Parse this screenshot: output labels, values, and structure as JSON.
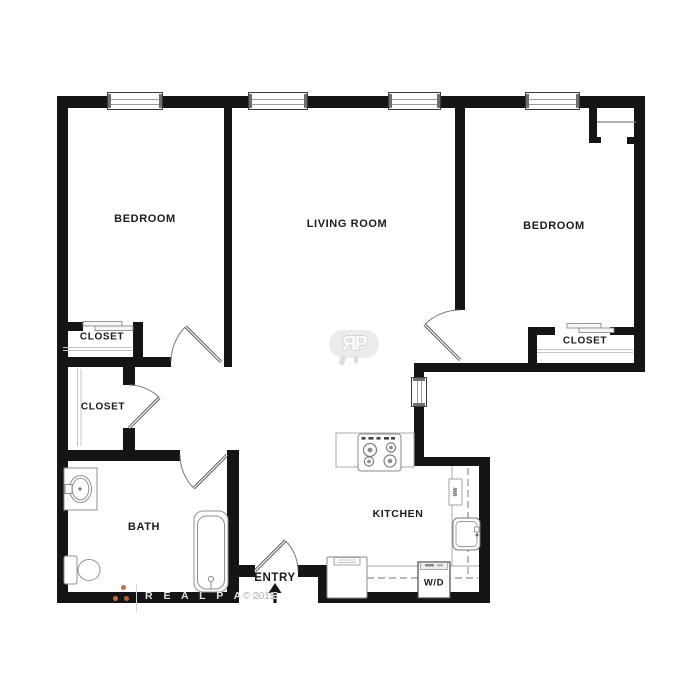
{
  "rooms": {
    "bedroom1": {
      "label": "BEDROOM"
    },
    "living_room": {
      "label": "LIVING ROOM"
    },
    "bedroom2": {
      "label": "BEDROOM"
    },
    "closet_bedroom1": {
      "label": "CLOSET"
    },
    "closet_hall": {
      "label": "CLOSET"
    },
    "closet_bedroom2": {
      "label": "CLOSET"
    },
    "bath": {
      "label": "BATH"
    },
    "kitchen": {
      "label": "KITCHEN"
    },
    "entry": {
      "label": "ENTRY"
    }
  },
  "appliances": {
    "washer_dryer": "W/D",
    "microwave": "MW"
  },
  "watermark": {
    "brand_spaced": "R E A L P A G E",
    "copyright": "© 2015",
    "logo_monogram": "ЯP"
  },
  "colors": {
    "wall": "#151515",
    "fixture_outline": "#909090",
    "label_text": "#1b1b1b",
    "watermark_gray": "#e3e3e3",
    "copyright_gray": "#b3b3b3",
    "logo_dot_orange": "#bf7244"
  }
}
